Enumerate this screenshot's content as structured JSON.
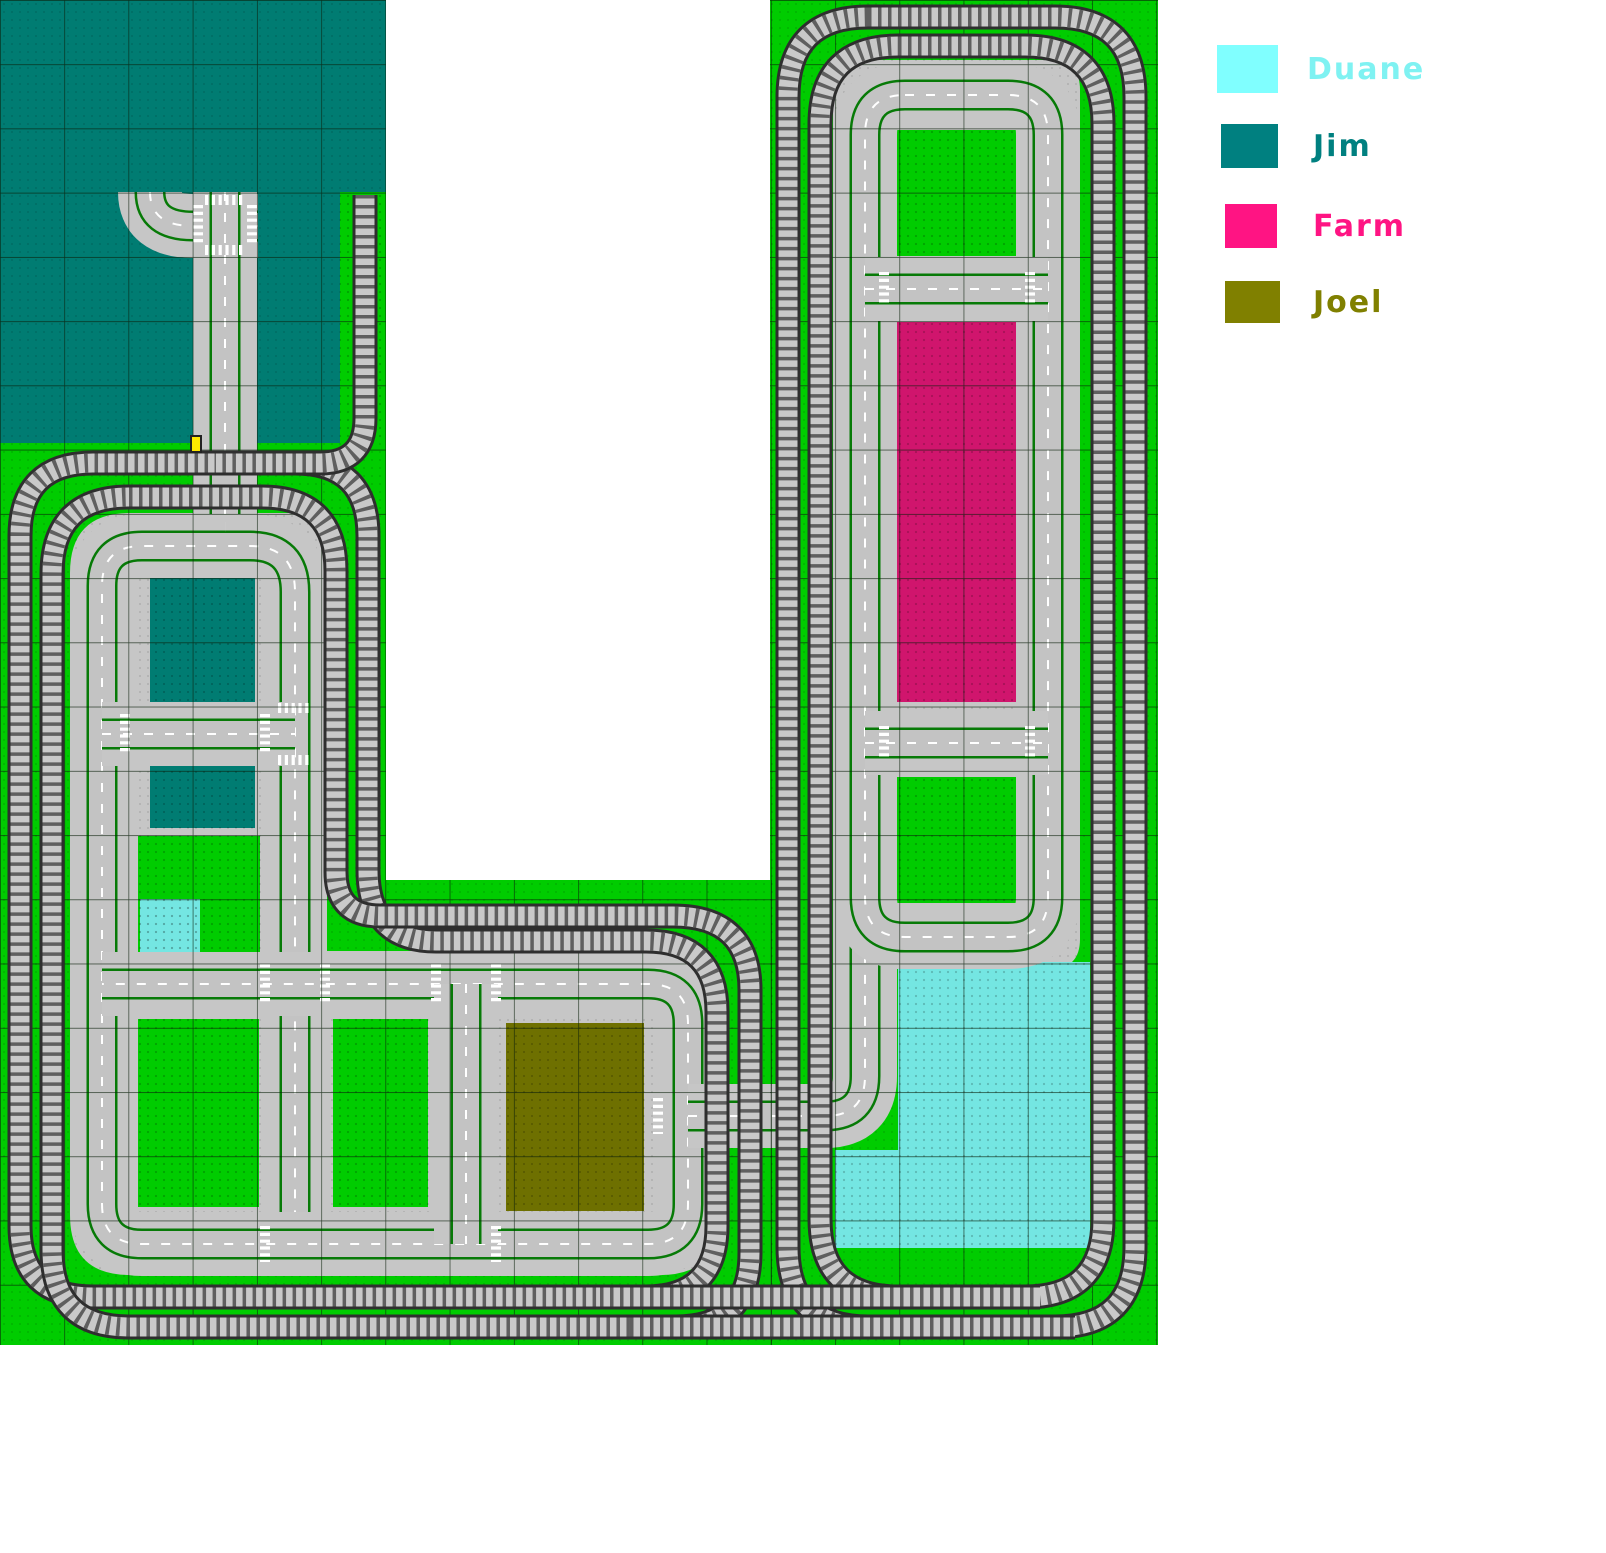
{
  "canvas": {
    "width": 1606,
    "height": 1553,
    "grid_cell": 64.24
  },
  "colors": {
    "green": "#00CC00",
    "teal": "#007C72",
    "cyan": "#74E6E2",
    "farm": "#D0156D",
    "olive": "#6E7000",
    "plate": "#C6C6C6",
    "road": "#C3C3C3",
    "road_edge": "#077A07",
    "center_line": "#FFFFFF",
    "grid_line": "#0A1F0A",
    "track_outline": "#2E2E2E",
    "track_bed": "#C9C9C9",
    "track_tie": "#5F5F5F",
    "signal_yellow": "#FFE800"
  },
  "legend": {
    "items": [
      {
        "label": "Duane",
        "swatch_color": "#80FFFF",
        "text_color": "#7FF2F2",
        "x": 1217,
        "y": 45,
        "sw": 61,
        "sh": 48,
        "label_dx": 90
      },
      {
        "label": "Jim",
        "swatch_color": "#008080",
        "text_color": "#008080",
        "x": 1221,
        "y": 124,
        "sw": 57,
        "sh": 44,
        "label_dx": 92
      },
      {
        "label": "Farm",
        "swatch_color": "#FF1483",
        "text_color": "#FF1483",
        "x": 1225,
        "y": 204,
        "sw": 52,
        "sh": 44,
        "label_dx": 88
      },
      {
        "label": "Joel",
        "swatch_color": "#808000",
        "text_color": "#808000",
        "x": 1225,
        "y": 281,
        "sw": 55,
        "sh": 42,
        "label_dx": 88
      }
    ]
  },
  "regions": [
    {
      "name": "jim-baseplate-area",
      "x": 0,
      "y": 0,
      "w": 386,
      "h": 443,
      "color": "teal"
    },
    {
      "name": "left-green-area",
      "x": 0,
      "y": 443,
      "w": 386,
      "h": 902,
      "color": "green"
    },
    {
      "name": "spur-green-strip",
      "x": 340,
      "y": 192,
      "w": 46,
      "h": 251,
      "color": "green"
    },
    {
      "name": "middle-green-area",
      "x": 386,
      "y": 880,
      "w": 386,
      "h": 465,
      "color": "green"
    },
    {
      "name": "right-green-area",
      "x": 770,
      "y": 0,
      "w": 388,
      "h": 1345,
      "color": "green"
    }
  ],
  "plates": [
    {
      "name": "left-loop-sidewalk-plate",
      "d": "M 130,513 H 327 V 951 H 660 Q 720,951 720,1011 V 1215 Q 720,1275 660,1275 H 130 Q 70,1275 70,1215 V 573 Q 70,513 130,513 Z"
    },
    {
      "name": "right-ring-sidewalk-plate",
      "d": "M 863,60 H 1050 Q 1080,60 1080,90 V 939 Q 1080,969 1050,969 H 863 Q 833,969 833,939 V 90 Q 833,60 863,60 Z"
    }
  ],
  "blocks": [
    {
      "name": "jim-inner-block-1",
      "x": 150,
      "y": 577,
      "w": 105,
      "h": 132,
      "color": "teal"
    },
    {
      "name": "jim-inner-block-2",
      "x": 150,
      "y": 760,
      "w": 105,
      "h": 68,
      "color": "teal"
    },
    {
      "name": "green-inner-block-1",
      "x": 138,
      "y": 836,
      "w": 122,
      "h": 122,
      "color": "green"
    },
    {
      "name": "duane-cell",
      "x": 140,
      "y": 899,
      "w": 60,
      "h": 60,
      "color": "cyan"
    },
    {
      "name": "green-inner-block-2",
      "x": 138,
      "y": 1019,
      "w": 121,
      "h": 188,
      "color": "green"
    },
    {
      "name": "green-inner-block-3",
      "x": 333,
      "y": 1019,
      "w": 95,
      "h": 188,
      "color": "green"
    },
    {
      "name": "joel-block",
      "x": 506,
      "y": 1023,
      "w": 138,
      "h": 188,
      "color": "olive"
    },
    {
      "name": "right-green-block-1",
      "x": 897,
      "y": 130,
      "w": 121,
      "h": 126,
      "color": "green"
    },
    {
      "name": "farm-block",
      "x": 897,
      "y": 322,
      "w": 121,
      "h": 380,
      "color": "farm"
    },
    {
      "name": "right-green-block-2",
      "x": 897,
      "y": 777,
      "w": 121,
      "h": 126,
      "color": "green"
    },
    {
      "name": "duane-block-upper",
      "x": 898,
      "y": 962,
      "w": 192,
      "h": 188,
      "color": "cyan"
    },
    {
      "name": "duane-block-lower",
      "x": 835,
      "y": 1150,
      "w": 255,
      "h": 98,
      "color": "cyan"
    }
  ],
  "roads": [
    {
      "name": "road-curve-north-east",
      "d": "M 150,192 Q 150,226 193,226"
    },
    {
      "name": "road-stub-east",
      "d": "M 193,226 H 258"
    },
    {
      "name": "road-main-vertical",
      "d": "M 225,192 V 546"
    },
    {
      "name": "left-loop-west-top",
      "d": "M 102,1212 V 586 Q 102,546 142,546 H 250 Q 295,546 295,592 V 1244"
    },
    {
      "name": "left-loop-bottom",
      "d": "M 102,1204 Q 102,1244 142,1244 H 648 Q 688,1244 688,1204 V 1024"
    },
    {
      "name": "left-loop-road-b",
      "d": "M 688,1024 Q 688,984 648,984 H 102"
    },
    {
      "name": "left-inner-road-a",
      "d": "M 102,734 H 295"
    },
    {
      "name": "left-inner-road-d",
      "d": "M 466,984 V 1244"
    },
    {
      "name": "connector-road",
      "d": "M 688,1116 H 825 Q 865,1116 865,1076 V 920"
    },
    {
      "name": "right-ring-road",
      "d": "M 905,95 H 1008 Q 1048,95 1048,135 V 897 Q 1048,937 1008,937 H 905 Q 865,937 865,897 V 135 Q 865,95 905,95 Z"
    },
    {
      "name": "right-rung-north",
      "d": "M 865,289 H 1048"
    },
    {
      "name": "right-rung-south",
      "d": "M 865,743 H 1048"
    }
  ],
  "crosswalks": [
    {
      "x1": 205,
      "y1": 200,
      "x2": 245,
      "y2": 200
    },
    {
      "x1": 205,
      "y1": 250,
      "x2": 245,
      "y2": 250
    },
    {
      "x1": 198,
      "y1": 205,
      "x2": 198,
      "y2": 245
    },
    {
      "x1": 252,
      "y1": 205,
      "x2": 252,
      "y2": 245
    },
    {
      "x1": 225,
      "y1": 527,
      "x2": 225,
      "y2": 527
    },
    {
      "x1": 265,
      "y1": 714,
      "x2": 265,
      "y2": 754
    },
    {
      "x1": 278,
      "y1": 708,
      "x2": 312,
      "y2": 708
    },
    {
      "x1": 278,
      "y1": 760,
      "x2": 312,
      "y2": 760
    },
    {
      "x1": 125,
      "y1": 714,
      "x2": 125,
      "y2": 754
    },
    {
      "x1": 265,
      "y1": 964,
      "x2": 265,
      "y2": 1004
    },
    {
      "x1": 325,
      "y1": 964,
      "x2": 325,
      "y2": 1004
    },
    {
      "x1": 436,
      "y1": 964,
      "x2": 436,
      "y2": 1004
    },
    {
      "x1": 496,
      "y1": 964,
      "x2": 496,
      "y2": 1004
    },
    {
      "x1": 265,
      "y1": 1226,
      "x2": 265,
      "y2": 1262
    },
    {
      "x1": 496,
      "y1": 1226,
      "x2": 496,
      "y2": 1262
    },
    {
      "x1": 658,
      "y1": 1098,
      "x2": 658,
      "y2": 1134
    },
    {
      "x1": 884,
      "y1": 272,
      "x2": 884,
      "y2": 306
    },
    {
      "x1": 1030,
      "y1": 272,
      "x2": 1030,
      "y2": 306
    },
    {
      "x1": 884,
      "y1": 726,
      "x2": 884,
      "y2": 760
    },
    {
      "x1": 1030,
      "y1": 726,
      "x2": 1030,
      "y2": 760
    }
  ],
  "tracks": [
    {
      "name": "track-left-outer-loop",
      "d": "M 20,536 Q 20,463 93,463 H 295 Q 368,463 368,536 V 870 Q 368,941 436,941 H 646 Q 717,941 717,1012 V 1226 Q 717,1297 646,1297 H 93 Q 20,1297 20,1226 Z"
    },
    {
      "name": "track-left-inner-loop",
      "d": "M 129,497 H 262 Q 336,497 336,571 V 872 Q 336,916 380,916 H 673 Q 750,916 750,990 V 1253 Q 750,1327 676,1327 H 129 Q 52,1327 52,1250 V 574 Q 52,497 129,497 Z"
    },
    {
      "name": "track-spur-to-jim-area",
      "d": "M 365,195 V 418 Q 365,463 320,463 H 215"
    },
    {
      "name": "track-right-outer-loop",
      "d": "M 868,17 H 1055 Q 1135,17 1135,97 V 1247 Q 1135,1327 1055,1327 H 868 Q 788,1327 788,1247 V 97 Q 788,17 868,17 Z"
    },
    {
      "name": "track-right-inner-loop",
      "d": "M 898,46 H 1025 Q 1103,46 1103,124 V 1219 Q 1103,1297 1025,1297 H 898 Q 820,1297 820,1219 V 124 Q 820,46 898,46 Z"
    },
    {
      "name": "track-bottom-link-upper",
      "d": "M 600,1297 H 1040"
    },
    {
      "name": "track-bottom-link-lower",
      "d": "M 630,1327 H 1075"
    }
  ],
  "grid_areas": [
    {
      "name": "grid-left",
      "x": 0,
      "y": 0,
      "w": 386,
      "h": 1345
    },
    {
      "name": "grid-middle",
      "x": 386,
      "y": 880,
      "w": 386,
      "h": 465
    },
    {
      "name": "grid-right",
      "x": 770,
      "y": 0,
      "w": 388,
      "h": 1345
    }
  ],
  "signal": {
    "name": "railway-signal",
    "x": 191,
    "y": 436,
    "w": 10,
    "h": 16
  }
}
